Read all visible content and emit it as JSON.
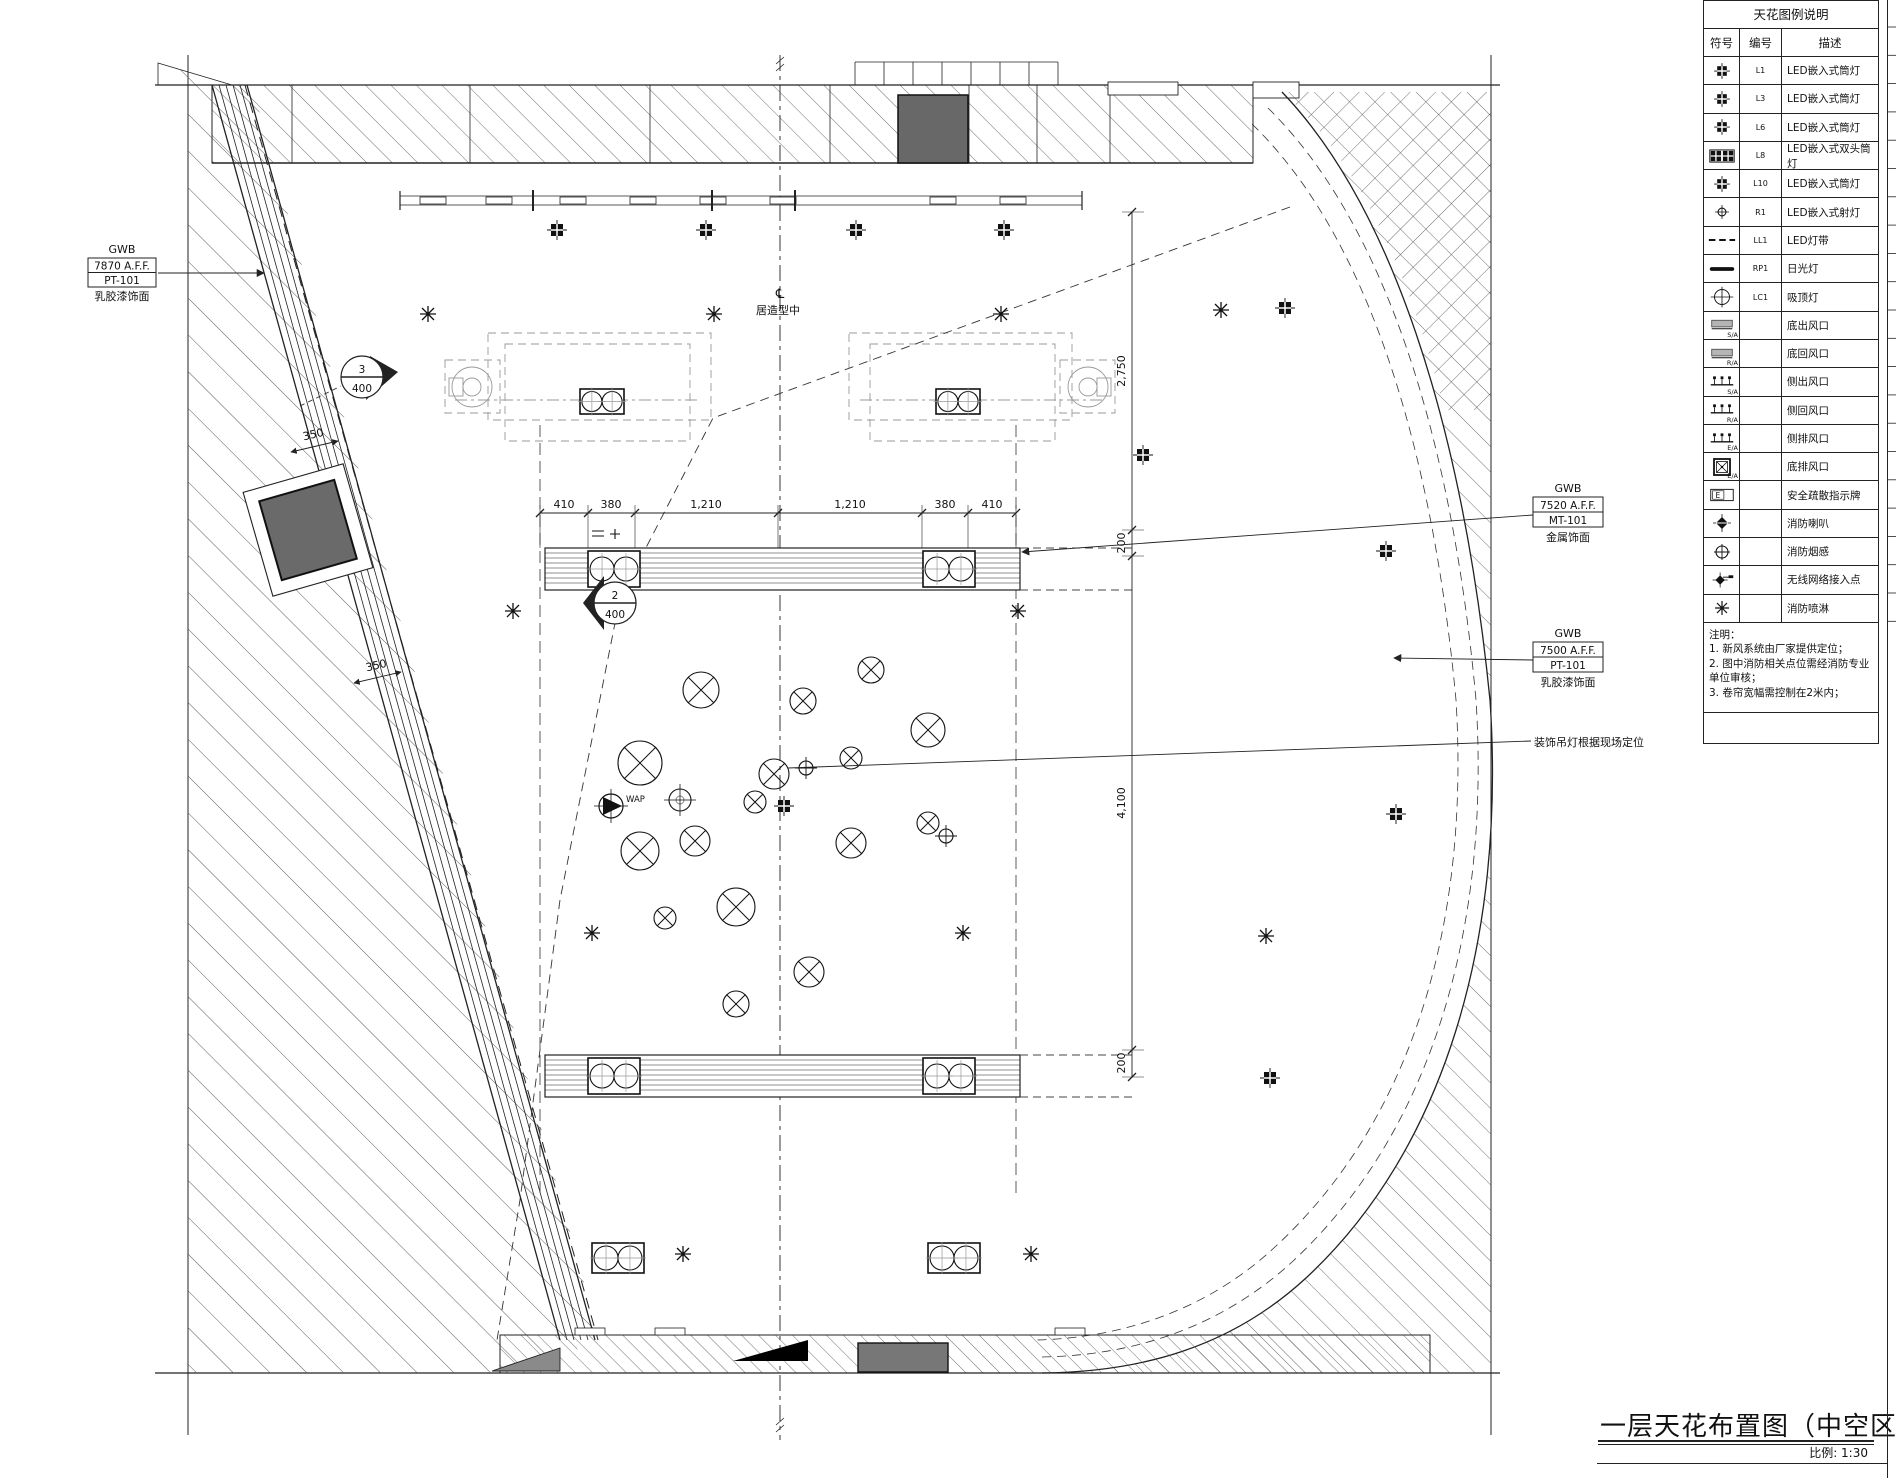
{
  "legend": {
    "title": "天花图例说明",
    "headers": [
      "符号",
      "编号",
      "描述"
    ],
    "rows": [
      {
        "icon": "downlight",
        "code": "L1",
        "desc": "LED嵌入式筒灯",
        "tag": ""
      },
      {
        "icon": "downlight",
        "code": "L3",
        "desc": "LED嵌入式筒灯",
        "tag": ""
      },
      {
        "icon": "downlight",
        "code": "L6",
        "desc": "LED嵌入式筒灯",
        "tag": ""
      },
      {
        "icon": "downlight-double",
        "code": "L8",
        "desc": "LED嵌入式双头筒灯",
        "tag": ""
      },
      {
        "icon": "downlight",
        "code": "L10",
        "desc": "LED嵌入式筒灯",
        "tag": ""
      },
      {
        "icon": "spotlight",
        "code": "R1",
        "desc": "LED嵌入式射灯",
        "tag": ""
      },
      {
        "icon": "led-strip",
        "code": "LL1",
        "desc": "LED灯带",
        "tag": ""
      },
      {
        "icon": "fluorescent",
        "code": "RP1",
        "desc": "日光灯",
        "tag": ""
      },
      {
        "icon": "ceiling-lamp",
        "code": "LC1",
        "desc": "吸顶灯",
        "tag": ""
      },
      {
        "icon": "vent-bottom",
        "code": "",
        "desc": "底出风口",
        "tag": "S/A"
      },
      {
        "icon": "vent-bottom",
        "code": "",
        "desc": "底回风口",
        "tag": "R/A"
      },
      {
        "icon": "vent-side",
        "code": "",
        "desc": "侧出风口",
        "tag": "S/A"
      },
      {
        "icon": "vent-side",
        "code": "",
        "desc": "侧回风口",
        "tag": "R/A"
      },
      {
        "icon": "vent-side",
        "code": "",
        "desc": "侧排风口",
        "tag": "E/A"
      },
      {
        "icon": "vent-exhaust",
        "code": "",
        "desc": "底排风口",
        "tag": "E/A"
      },
      {
        "icon": "exit-sign",
        "code": "",
        "desc": "安全疏散指示牌",
        "tag": ""
      },
      {
        "icon": "fire-speaker",
        "code": "",
        "desc": "消防喇叭",
        "tag": ""
      },
      {
        "icon": "smoke-detector",
        "code": "",
        "desc": "消防烟感",
        "tag": ""
      },
      {
        "icon": "wireless-ap",
        "code": "",
        "desc": "无线网络接入点",
        "tag": ""
      },
      {
        "icon": "sprinkler",
        "code": "",
        "desc": "消防喷淋",
        "tag": ""
      }
    ]
  },
  "notes": {
    "title": "注明：",
    "items": [
      "1. 新风系统由厂家提供定位；",
      "2. 图中消防相关点位需经消防专业单位审核；",
      "3. 卷帘宽幅需控制在2米内；"
    ]
  },
  "labels": {
    "gwb_left": {
      "head": "GWB",
      "line1": "7870  A.F.F.",
      "line2": "PT-101",
      "sub": "乳胶漆饰面"
    },
    "gwb_mid": {
      "head": "GWB",
      "line1": "7520  A.F.F.",
      "line2": "MT-101",
      "sub": "金属饰面"
    },
    "gwb_low": {
      "head": "GWB",
      "line1": "7500  A.F.F.",
      "line2": "PT-101",
      "sub": "乳胶漆饰面"
    },
    "pendant_note": "装饰吊灯根据现场定位",
    "center_mark": "℄",
    "center_text": "居造型中",
    "wap": "WAP"
  },
  "callouts": {
    "c2": {
      "num": "2",
      "den": "400"
    },
    "c3": {
      "num": "3",
      "den": "400"
    }
  },
  "dims": {
    "top": [
      "410",
      "380",
      "1,210",
      "1,210",
      "380",
      "410"
    ],
    "right": [
      "2,750",
      "200",
      "4,100",
      "200"
    ],
    "left": [
      "350",
      "350"
    ]
  },
  "title_block": {
    "title": "一层天花布置图（中空区域）",
    "scale": "比例: 1:30"
  }
}
